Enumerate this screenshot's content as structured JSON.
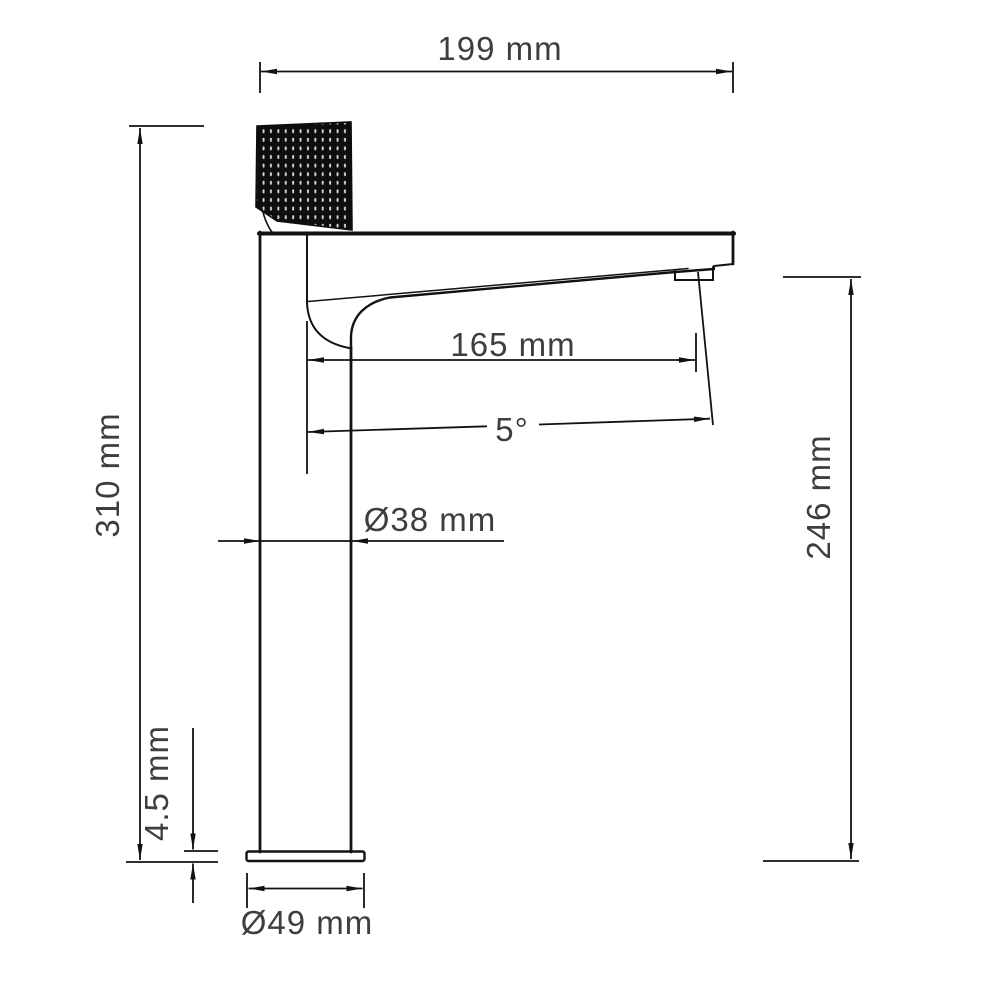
{
  "drawing": {
    "subject": "single-handle tall basin faucet, side elevation with dimensions",
    "units": "mm",
    "colors": {
      "line": "#121212",
      "text": "#3e3e3e",
      "handle_fill": "#0e0e0e"
    },
    "dims": {
      "width": "199 mm",
      "height": "310 mm",
      "spout_reach": "165 mm",
      "spout_angle": "5°",
      "body_diameter": "Ø38 mm",
      "base_thickness": "4.5 mm",
      "base_diameter": "Ø49 mm",
      "outlet_height": "246 mm"
    }
  }
}
